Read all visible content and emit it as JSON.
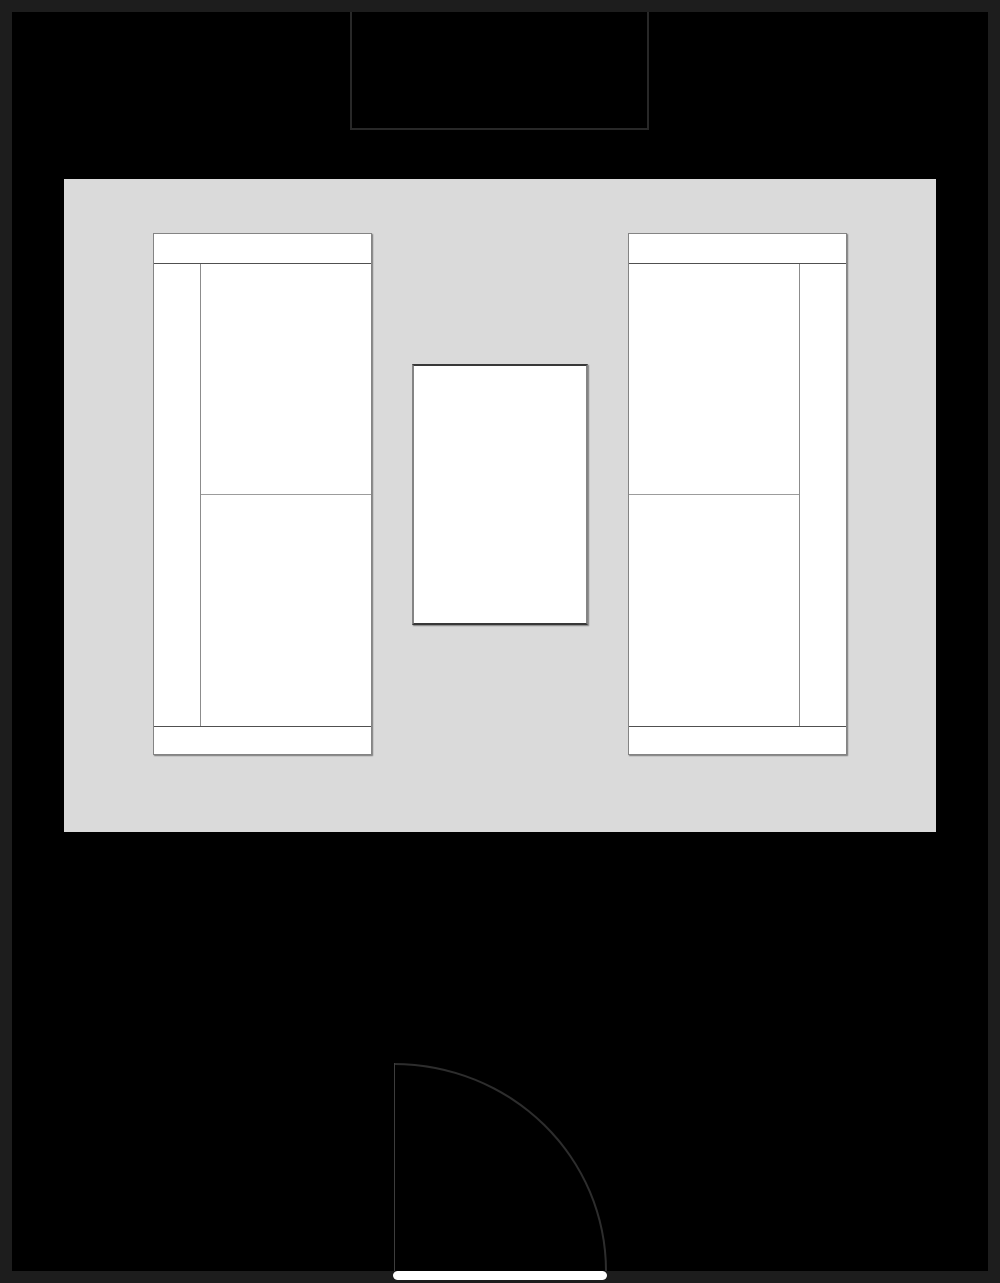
{
  "colors": {
    "frame": "#1d1d1d",
    "floor": "#000000",
    "niche_border": "#282828",
    "rug": "#dadada",
    "furniture_fill": "#ffffff",
    "furniture_border": "#848484",
    "armrest_line": "#505050",
    "cushion_line": "#9c9c9c",
    "backrest_line": "#8c8c8c",
    "table_border": "#383838",
    "door_arc": "#2d2d2d",
    "door_leaf": "#3d3d3d",
    "door_opening": "#ffffff"
  },
  "floorplan": {
    "canvas": {
      "width": 1000,
      "height": 1283
    },
    "wall_thickness": 12,
    "elements": {
      "window_niche": {
        "label": "window-niche",
        "x": 350,
        "y": 12,
        "w": 299,
        "h": 118
      },
      "rug": {
        "label": "area-rug",
        "x": 64,
        "y": 179,
        "w": 872,
        "h": 653
      },
      "sofa_left": {
        "label": "left-sofa",
        "x": 153,
        "y": 233,
        "w": 219,
        "h": 522
      },
      "sofa_left_arm_top": {
        "label": "left-sofa-top-armrest",
        "x": 154,
        "y": 263,
        "w": 217,
        "h": 1
      },
      "sofa_left_arm_bottom": {
        "label": "left-sofa-bottom-armrest",
        "x": 154,
        "y": 726,
        "w": 217,
        "h": 1
      },
      "sofa_left_backrest": {
        "label": "left-sofa-backrest",
        "x": 200,
        "y": 264,
        "w": 1,
        "h": 462
      },
      "sofa_left_cushion": {
        "label": "left-sofa-cushion-split",
        "x": 201,
        "y": 494,
        "w": 170,
        "h": 1
      },
      "sofa_right": {
        "label": "right-sofa",
        "x": 628,
        "y": 233,
        "w": 219,
        "h": 522
      },
      "sofa_right_arm_top": {
        "label": "right-sofa-top-armrest",
        "x": 629,
        "y": 263,
        "w": 217,
        "h": 1
      },
      "sofa_right_arm_bottom": {
        "label": "right-sofa-bottom-armrest",
        "x": 629,
        "y": 726,
        "w": 217,
        "h": 1
      },
      "sofa_right_backrest": {
        "label": "right-sofa-backrest",
        "x": 799,
        "y": 264,
        "w": 1,
        "h": 462
      },
      "sofa_right_cushion": {
        "label": "right-sofa-cushion-split",
        "x": 629,
        "y": 494,
        "w": 170,
        "h": 1
      },
      "coffee_table": {
        "label": "coffee-table",
        "x": 412,
        "y": 364,
        "w": 176,
        "h": 261
      },
      "door_swing": {
        "label": "door-swing-arc",
        "x": 394,
        "y": 1063,
        "w": 213,
        "h": 208
      },
      "door_leaf": {
        "label": "door-leaf",
        "x": 394,
        "y": 1063,
        "w": 1,
        "h": 208
      },
      "door_opening": {
        "label": "door-opening-threshold",
        "x": 393,
        "y": 1271,
        "w": 214,
        "h": 9
      }
    }
  }
}
